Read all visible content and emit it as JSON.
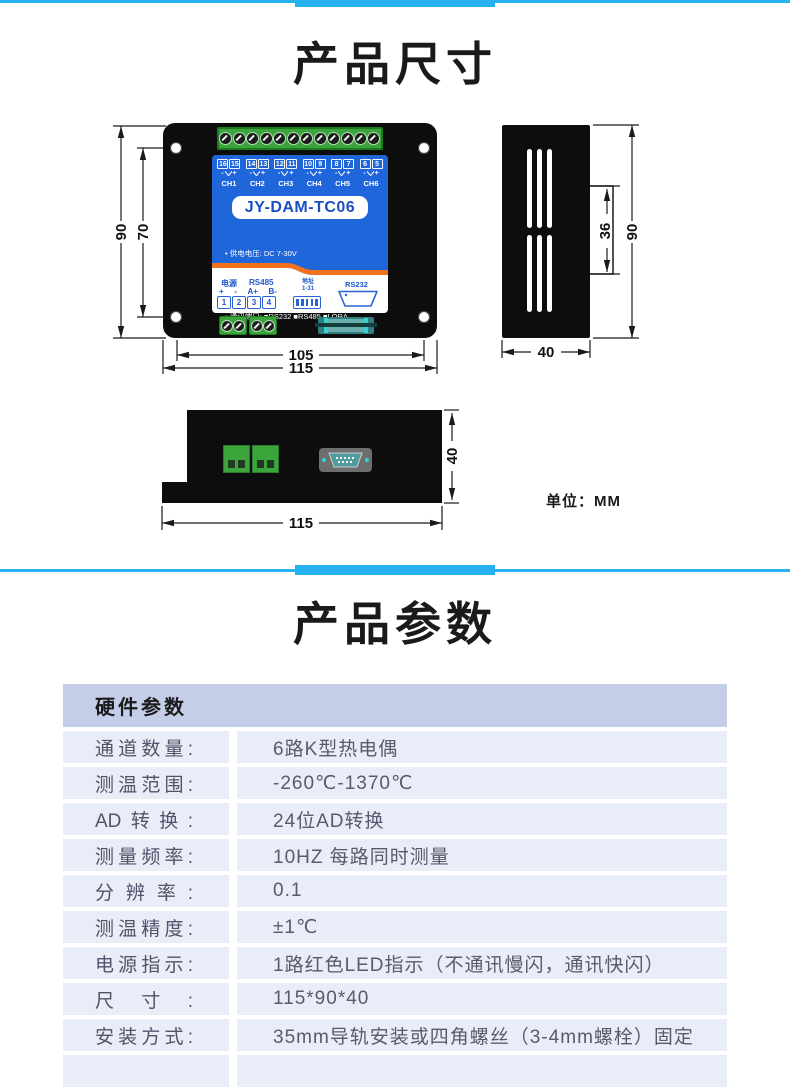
{
  "page": {
    "title_dimensions": "产品尺寸",
    "title_params": "产品参数",
    "unit_label": "单位：MM"
  },
  "colors": {
    "accent_cyan": "#29b2f0",
    "panel_blue": "#1f66db",
    "swoosh_orange": "#f2711c",
    "terminal_green": "#3ba43b",
    "table_header_bg": "#c4cee9",
    "table_row_bg": "#e9edf8"
  },
  "device": {
    "model": "JY-DAM-TC06",
    "terminal_pairs": [
      {
        "a": "16",
        "b": "15"
      },
      {
        "a": "14",
        "b": "13"
      },
      {
        "a": "12",
        "b": "11"
      },
      {
        "a": "10",
        "b": "9"
      },
      {
        "a": "8",
        "b": "7"
      },
      {
        "a": "6",
        "b": "5"
      }
    ],
    "tc_minus": "-",
    "tc_plus": "+",
    "channels": [
      "CH1",
      "CH2",
      "CH3",
      "CH4",
      "CH5",
      "CH6"
    ],
    "specs": [
      "• 供电电压: DC 7-30V",
      "• 测温范围: -260~1370℃",
      "• 通讯端口: ■RS232 ■RS485 ■LORA",
      "■网口  ■WIFI  ■GPRS ■USB"
    ],
    "labels": {
      "power": "电源",
      "rs485": "RS485",
      "plus": "+",
      "minus": "-",
      "aplus": "A+",
      "bminus": "B-",
      "terminals": [
        "1",
        "2",
        "3",
        "4"
      ],
      "addr": "地址",
      "addr_range": "1-31",
      "rs232": "RS232"
    }
  },
  "dims": {
    "front_height": "90",
    "front_inner_height": "70",
    "front_inner_width": "105",
    "front_width": "115",
    "side_clip": "36",
    "side_height": "90",
    "side_depth": "40",
    "bottom_depth": "40",
    "bottom_width": "115"
  },
  "table": {
    "header": "硬件参数",
    "rows": [
      {
        "label": "通道数量:",
        "value": "6路K型热电偶"
      },
      {
        "label": "测温范围:",
        "value": "-260℃-1370℃"
      },
      {
        "label": "AD转换:",
        "value": "24位AD转换"
      },
      {
        "label": "测量频率:",
        "value": "10HZ 每路同时测量"
      },
      {
        "label": "分辨率:",
        "value": "0.1"
      },
      {
        "label": "测温精度:",
        "value": "±1℃"
      },
      {
        "label": "电源指示:",
        "value": "1路红色LED指示（不通讯慢闪，通讯快闪）"
      },
      {
        "label": "尺寸:",
        "value": "115*90*40"
      },
      {
        "label": "安装方式:",
        "value": "35mm导轨安装或四角螺丝（3-4mm螺栓）固定"
      }
    ]
  }
}
